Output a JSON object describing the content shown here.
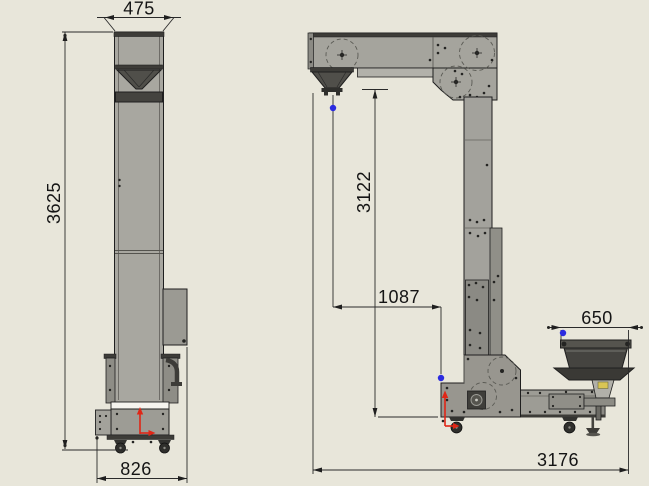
{
  "colors": {
    "background": "#e8e6da",
    "accent_red": "#e02616",
    "accent_blue": "#2b2be0",
    "ink": "#1f1f1f"
  },
  "front_view": {
    "dimensions": {
      "top_width": "475",
      "overall_height": "3625",
      "base_width": "826"
    }
  },
  "side_view": {
    "dimensions": {
      "drop_height": "3122",
      "inlet_offset": "1087",
      "feeder_width": "650",
      "overall_length": "3176"
    }
  }
}
